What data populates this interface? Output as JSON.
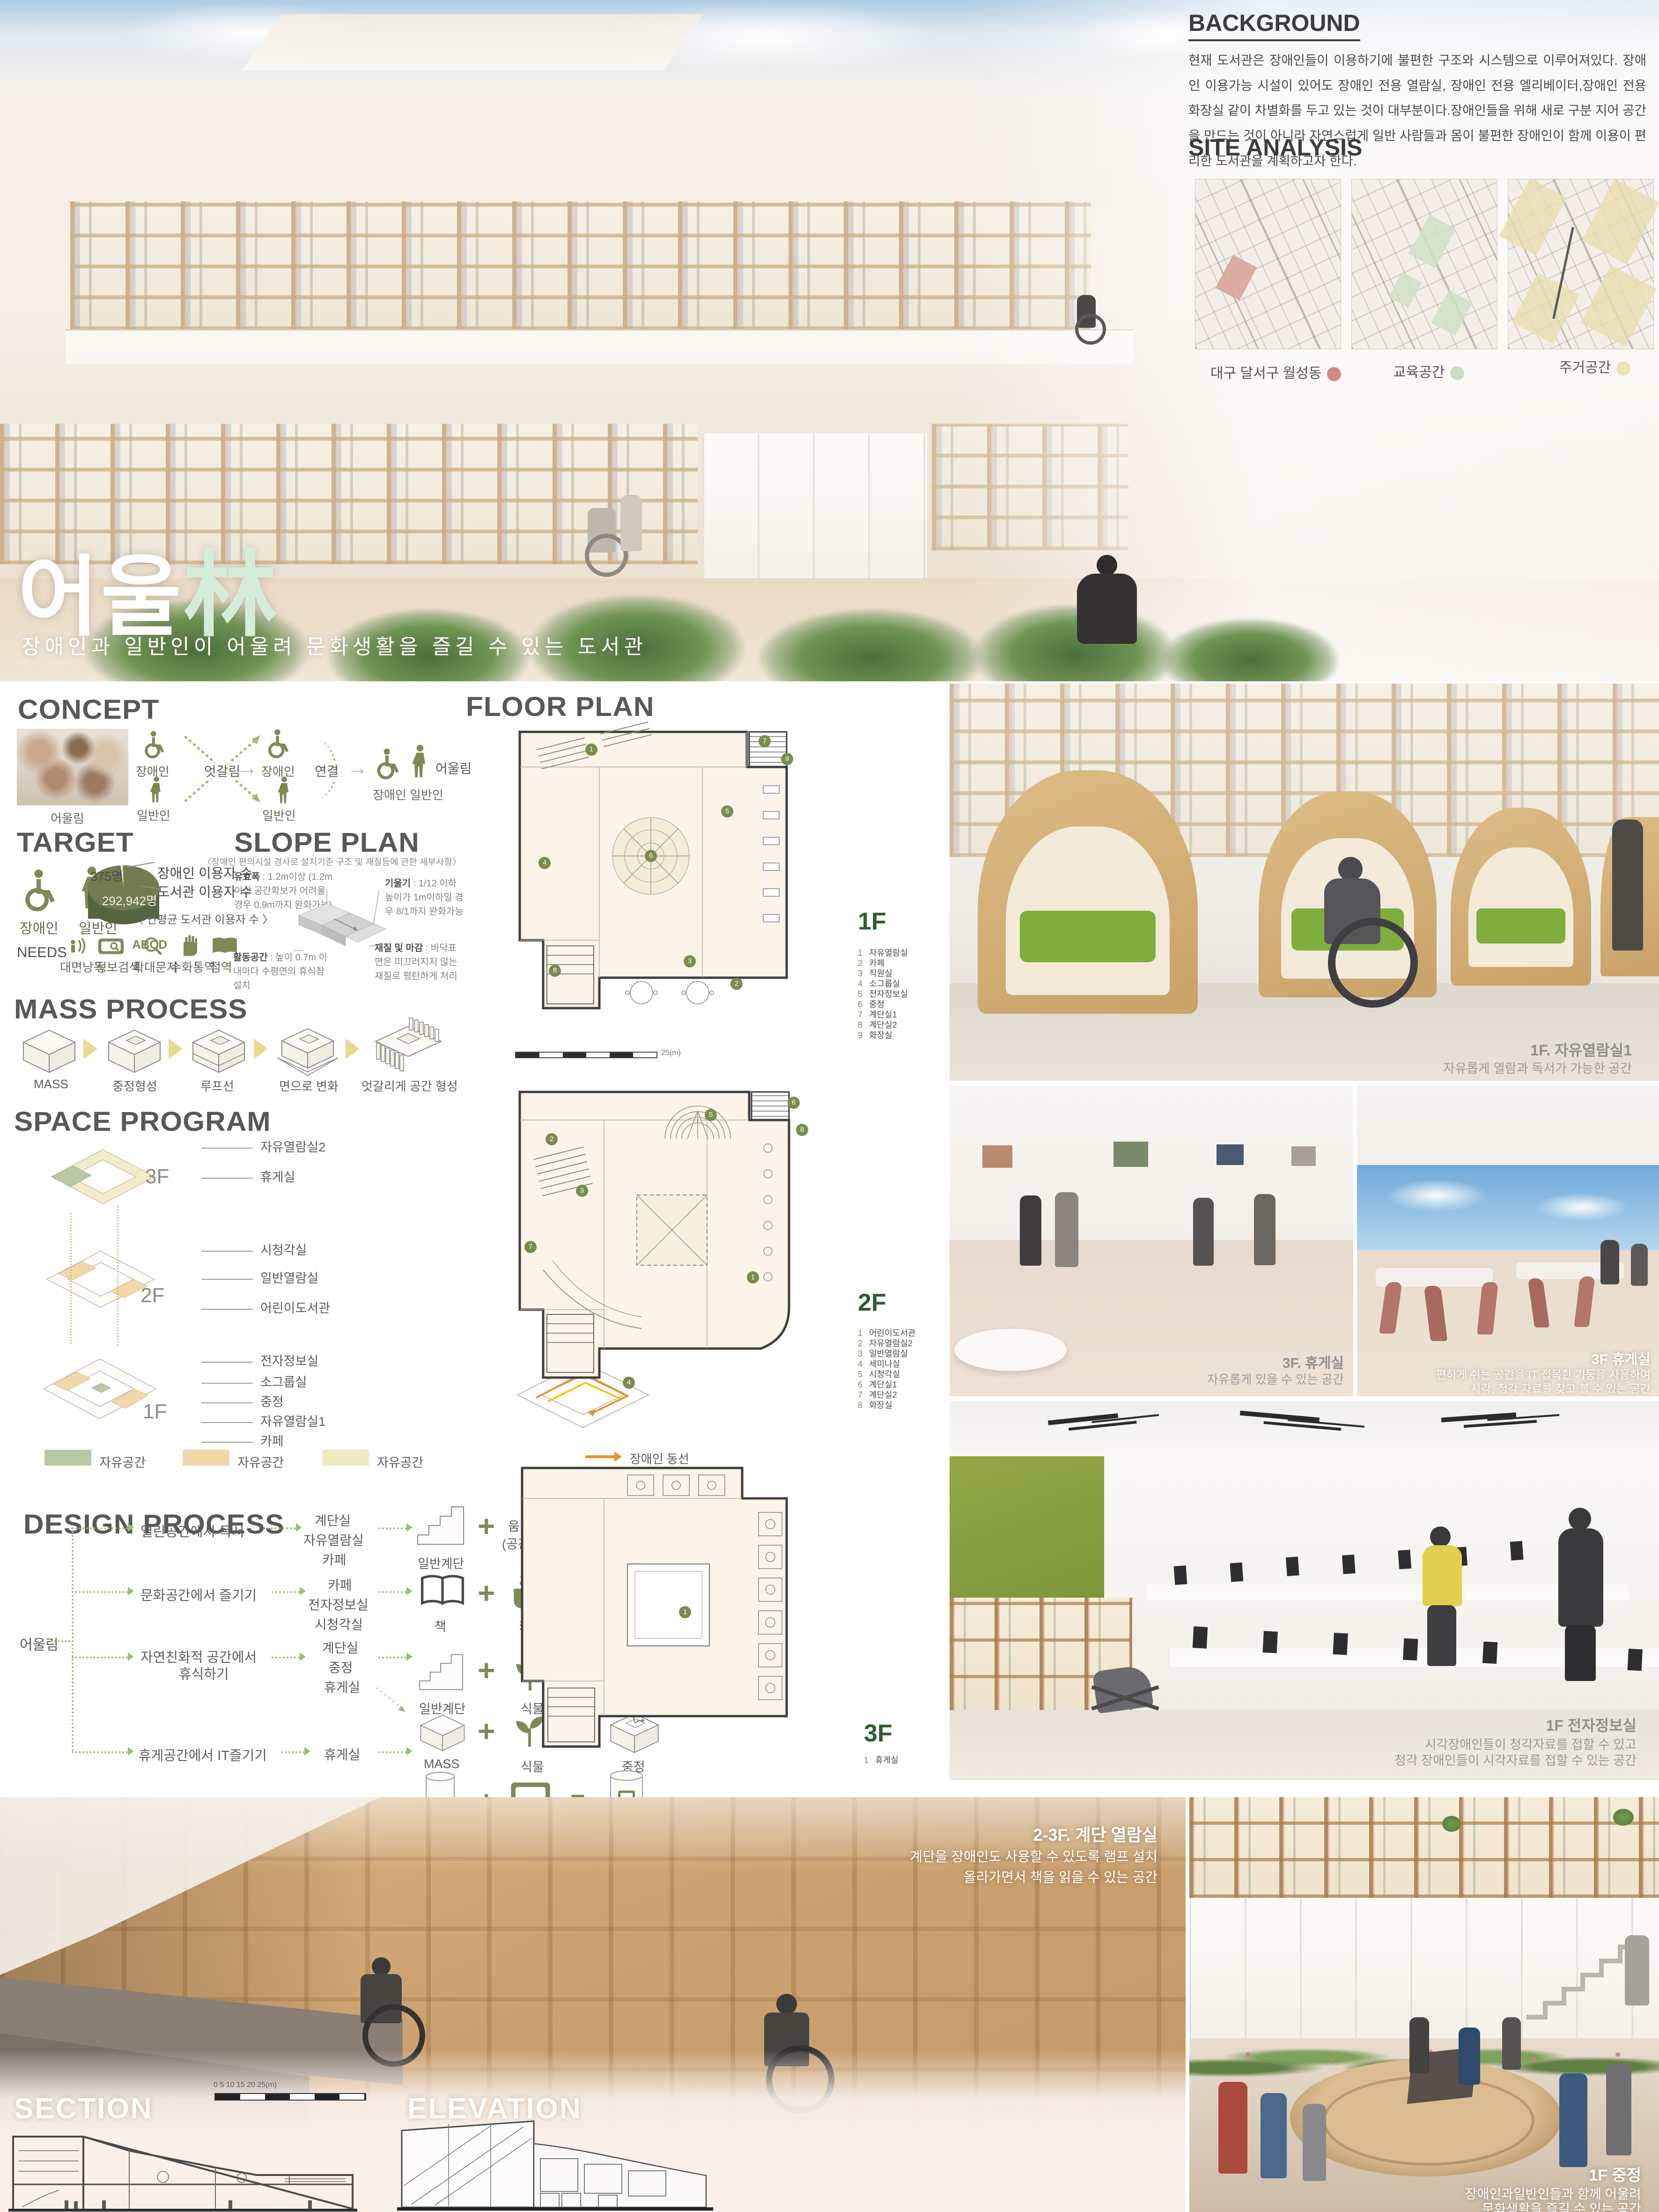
{
  "hero": {
    "title_main": "어울",
    "title_hanja": "林",
    "subtitle": "장애인과 일반인이 어울려 문화생활을 즐길 수 있는 도서관"
  },
  "background_panel": {
    "heading": "BACKGROUND",
    "body": "현재 도서관은 장애인들이 이용하기에 불편한 구조와 시스템으로 이루어져있다. 장애인 이용가능 시설이 있어도 장애인 전용 열람실, 장애인 전용 엘리베이터,장애인 전용 화장실 같이 차별화를 두고 있는 것이 대부분이다.장애인들을 위해 새로 구분 지어 공간을 만드는 것이 아니라 자연스럽게 일반 사람들과 몸이 불편한 장애인이 함께 이용이 편리한 도서관을 계획하고자 한다."
  },
  "site_analysis": {
    "heading": "SITE ANALYSIS",
    "maps": [
      {
        "label": "대구 달서구 월성동",
        "dot_color": "#c9776d"
      },
      {
        "label": "교육공간",
        "dot_color": "#c3d9b6"
      },
      {
        "label": "주거공간",
        "dot_color": "#eadfa9"
      }
    ]
  },
  "concept": {
    "heading": "CONCEPT",
    "photo_caption": "어울림",
    "label_disabled": "장애인",
    "label_general": "일반인",
    "label_cross": "엇갈림",
    "label_disabled2": "장애인",
    "label_general2": "일반인",
    "label_connect": "연결",
    "label_together": "어울림",
    "label_pair": "장애인  일반인"
  },
  "target": {
    "heading": "TARGET",
    "label_disabled": "장애인",
    "label_general": "일반인",
    "pie": {
      "small_value": "375명",
      "small_name": "장애인 이용자 수",
      "big_value": "292,942명",
      "big_name": "도서관 이용자 수",
      "caption": "〈 연평균 도서관  이용자 수 〉"
    },
    "needs_label": "NEEDS",
    "needs": [
      "대면낭독",
      "정보검색",
      "확대문자",
      "수화통역",
      "점역"
    ]
  },
  "slope_plan": {
    "heading": "SLOPE PLAN",
    "subtitle": "〈장애인  편의시설 경사로 설치기준 구조 및 재질등에 관한 세부사항〉",
    "notes": [
      {
        "t": "유효폭",
        "b": " : 1.2m이상 (1.2m이상 공간확보가 어려울 경우 0.9m까지 완화가능)"
      },
      {
        "t": "기울기",
        "b": " : 1/12 이하 높이가 1m이하일 경우 8/1까지 완화가능"
      },
      {
        "t": "활동공간",
        "b": " : 높이 0.7m 이내마다 수평면의 휴식참 설치"
      },
      {
        "t": "재질 및 마감",
        "b": " : 바닥표면은 미끄러지지 않는 재질로 평탄하게 처리"
      }
    ]
  },
  "mass_process": {
    "heading": "MASS PROCESS",
    "steps": [
      "MASS",
      "중정형성",
      "루프선",
      "면으로 변화",
      "엇갈리게 공간 형성"
    ]
  },
  "space_program": {
    "heading": "SPACE PROGRAM",
    "floor3_label": "3F",
    "floor2_label": "2F",
    "floor1_label": "1F",
    "labels3": [
      "자유열람실2",
      "휴게실"
    ],
    "labels2": [
      "시청각실",
      "일반열람실",
      "어린이도서관"
    ],
    "labels1": [
      "전자정보실",
      "소그룹실",
      "중정",
      "자유열람실1",
      "카페"
    ],
    "legend": [
      {
        "label": "자유공간",
        "color": "#b9c8a2"
      },
      {
        "label": "자유공간",
        "color": "#f2d8a8"
      },
      {
        "label": "자유공간",
        "color": "#efeabf"
      }
    ],
    "circulation": [
      {
        "label": "장애인 동선",
        "color": "#e8912d"
      },
      {
        "label": "일반인 동선",
        "color": "#f7c414"
      }
    ]
  },
  "design_process": {
    "heading": "DESIGN PROCESS",
    "root": "어울림",
    "rows": [
      {
        "goal": "열린공간에서 독서",
        "rooms": [
          "계단실",
          "자유열람실",
          "카페"
        ],
        "a": "일반계단",
        "b": "움직임",
        "b2": "(공간 분할)",
        "result": "엇갈리는 층"
      },
      {
        "goal": "문화공간에서 즐기기",
        "rooms": [
          "카페",
          "전자정보실",
          "시청각실"
        ],
        "a": "책",
        "b": "카페",
        "result": "북카페"
      },
      {
        "goal": "자연친화적 공간에서",
        "goal2": "휴식하기",
        "rooms": [
          "계단실",
          "중정",
          "휴게실"
        ],
        "a": "일반계단",
        "b": "식물",
        "result": "자연친화적계단"
      },
      {
        "a": "MASS",
        "b": "식물",
        "result": "중정"
      },
      {
        "goal": "휴게공간에서 IT즐기기",
        "rooms": [
          "휴게실"
        ],
        "a": "기둥",
        "b": "컴퓨터",
        "result": "옥상휴게실"
      }
    ]
  },
  "floor_plan": {
    "heading": "FLOOR PLAN",
    "scale_label": "25(m)",
    "floors": [
      {
        "name": "1F",
        "items": [
          {
            "n": "1",
            "label": "자유열람실"
          },
          {
            "n": "2",
            "label": "카페"
          },
          {
            "n": "3",
            "label": "직원실"
          },
          {
            "n": "4",
            "label": "소그룹실"
          },
          {
            "n": "5",
            "label": "전자정보실"
          },
          {
            "n": "6",
            "label": "중정"
          },
          {
            "n": "7",
            "label": "계단실1"
          },
          {
            "n": "8",
            "label": "계단실2"
          },
          {
            "n": "9",
            "label": "화장실"
          }
        ]
      },
      {
        "name": "2F",
        "items": [
          {
            "n": "1",
            "label": "어린이도서관"
          },
          {
            "n": "2",
            "label": "자유열람실2"
          },
          {
            "n": "3",
            "label": "일반열람실"
          },
          {
            "n": "4",
            "label": "세미나실"
          },
          {
            "n": "5",
            "label": "시청각실"
          },
          {
            "n": "6",
            "label": "계단실1"
          },
          {
            "n": "7",
            "label": "계단실2"
          },
          {
            "n": "8",
            "label": "화장실"
          }
        ]
      },
      {
        "name": "3F",
        "items": [
          {
            "n": "1",
            "label": "휴게실"
          }
        ]
      }
    ]
  },
  "renders": {
    "reading1": {
      "title": "1F. 자유열람실1",
      "line1": "자유롭게 열람과 독서가 가능한 공간"
    },
    "lounge_a": {
      "title": "3F. 휴게실",
      "line1": "자유롭게 있을 수 있는 공간"
    },
    "lounge_b": {
      "title": "3F 휴게실",
      "line1": "편하게 쉬는 공간을 IT 접목한 기둥을 사용하여",
      "line2": "시각, 청각 자료를 찾고 볼 수 있는 공간"
    },
    "digital": {
      "title": "1F 전자정보실",
      "line1": "시각장애인들이 청각자료를 접할 수 있고",
      "line2": "청각 장애인들이 시각자료를 접할 수 있는 공간"
    },
    "stair": {
      "title": "2-3F. 계단 열람실",
      "line1": "계단을 장애인도 사용할 수 있도록 램프 설치",
      "line2": "올라가면서 책을 읽을 수 있는 공간"
    },
    "courtyard": {
      "title": "1F 중정",
      "line1": "장애인과일반인들과 함께 어울려",
      "line2": "문화생활을 즐길 수 있는 공간"
    }
  },
  "drawings": {
    "section_label": "SECTION",
    "elevation_label": "ELEVATION",
    "scale_label": "0      5      10     15     20    25(m)"
  }
}
